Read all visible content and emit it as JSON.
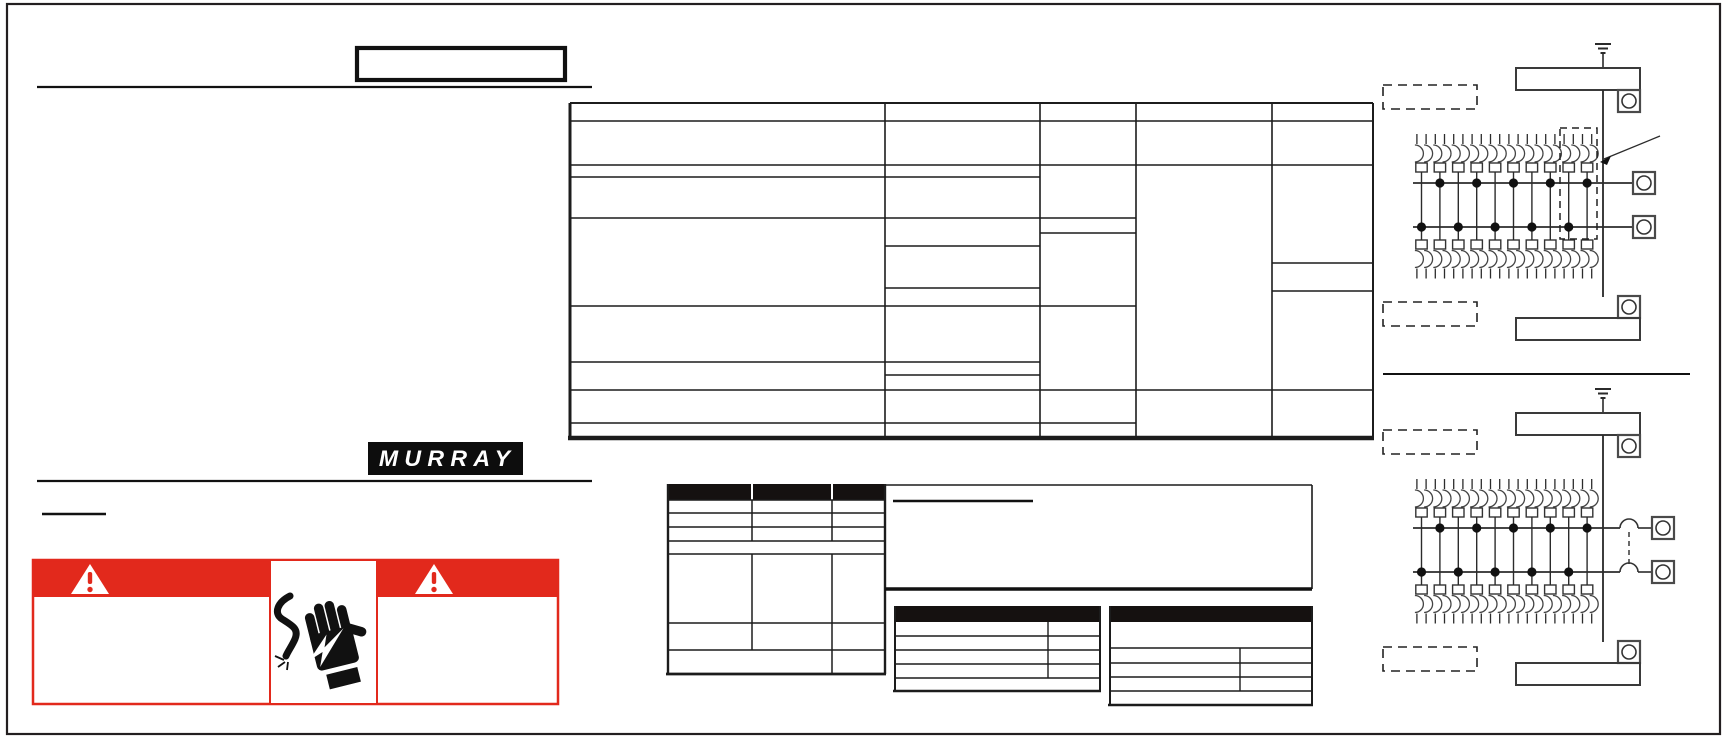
{
  "page": {
    "kind": "scanned installation instruction sheet (text layer blank)",
    "background": "#ffffff",
    "ink_color": "#1f1f1f",
    "border_color": "#231f20"
  },
  "brand": {
    "wordmark": "MURRAY",
    "logo_bg": "#0d0d0d",
    "logo_text_color": "#ffffff"
  },
  "title_box": {
    "text": ""
  },
  "top_rule": {
    "text_above": ""
  },
  "catalog_table": {
    "columns": 5,
    "all_cells_empty": true,
    "header_row_text": [
      "",
      "",
      "",
      "",
      ""
    ]
  },
  "parts_table": {
    "header_cells": [
      "",
      "",
      ""
    ],
    "header_bg": "#151110",
    "all_cells_empty": true
  },
  "note_panel": {
    "heading_text": "",
    "body_text": ""
  },
  "spec_table_left": {
    "header_text": "",
    "header_bg": "#151110",
    "rows": 5,
    "all_cells_empty": true
  },
  "spec_table_right": {
    "header_text": "",
    "header_bg": "#151110",
    "rows": 5,
    "all_cells_empty": true
  },
  "warning_label": {
    "accent_color": "#e2291c",
    "banner_text": "",
    "body_text": "",
    "icons": [
      "warning-triangle-icon",
      "warning-triangle-icon",
      "electric-shock-hand-icon"
    ]
  },
  "diagrams": [
    {
      "name": "main-lug-load-center",
      "branch_breakers_top_row": 10,
      "branch_breakers_bottom_row": 10,
      "upper_bus_taps": 5,
      "lower_bus_taps": 5,
      "neutral_bars": 2,
      "lug_terminals": 4,
      "has_dashed_callout_with_arrow": true,
      "has_main_breaker": false,
      "label_boxes_dashed": [
        "",
        ""
      ]
    },
    {
      "name": "main-breaker-load-center",
      "branch_breakers_top_row": 10,
      "branch_breakers_bottom_row": 10,
      "upper_bus_taps": 5,
      "lower_bus_taps": 5,
      "neutral_bars": 2,
      "lug_terminals": 4,
      "has_dashed_callout_with_arrow": false,
      "has_main_breaker": true,
      "label_boxes_dashed": [
        "",
        ""
      ]
    }
  ]
}
